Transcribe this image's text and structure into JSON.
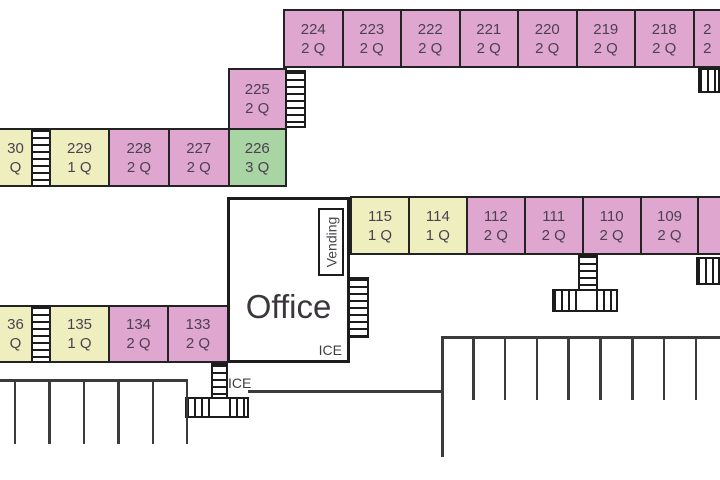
{
  "title": "Motel room layout floor plan",
  "colors": {
    "room_two_queen": "#dfa7d0",
    "room_one_queen": "#efeebf",
    "room_three_queen": "#a9d4a4",
    "outline": "#232323",
    "room_text": "#4c4150",
    "parking_line": "#3b3b3b"
  },
  "rooms": {
    "top": [
      {
        "num": "224",
        "beds": "2 Q"
      },
      {
        "num": "223",
        "beds": "2 Q"
      },
      {
        "num": "222",
        "beds": "2 Q"
      },
      {
        "num": "221",
        "beds": "2 Q"
      },
      {
        "num": "220",
        "beds": "2 Q"
      },
      {
        "num": "219",
        "beds": "2 Q"
      },
      {
        "num": "218",
        "beds": "2 Q"
      },
      {
        "num": "2",
        "beds": "2"
      }
    ],
    "unit_225": {
      "num": "225",
      "beds": "2 Q"
    },
    "unit_226": {
      "num": "226",
      "beds": "3 Q"
    },
    "west_upper": [
      {
        "num": "30",
        "beds": "Q"
      },
      {
        "num": "229",
        "beds": "1 Q"
      },
      {
        "num": "228",
        "beds": "2 Q"
      },
      {
        "num": "227",
        "beds": "2 Q"
      }
    ],
    "center": [
      {
        "num": "115",
        "beds": "1 Q"
      },
      {
        "num": "114",
        "beds": "1 Q"
      },
      {
        "num": "112",
        "beds": "2 Q"
      },
      {
        "num": "111",
        "beds": "2 Q"
      },
      {
        "num": "110",
        "beds": "2 Q"
      },
      {
        "num": "109",
        "beds": "2 Q"
      },
      {
        "num": "",
        "beds": ""
      }
    ],
    "west_lower": [
      {
        "num": "36",
        "beds": "Q"
      },
      {
        "num": "135",
        "beds": "1 Q"
      },
      {
        "num": "134",
        "beds": "2 Q"
      },
      {
        "num": "133",
        "beds": "2 Q"
      }
    ]
  },
  "office": {
    "label": "Office",
    "ice": "ICE",
    "vending": "Vending"
  },
  "ice_station": {
    "label": "ICE"
  }
}
